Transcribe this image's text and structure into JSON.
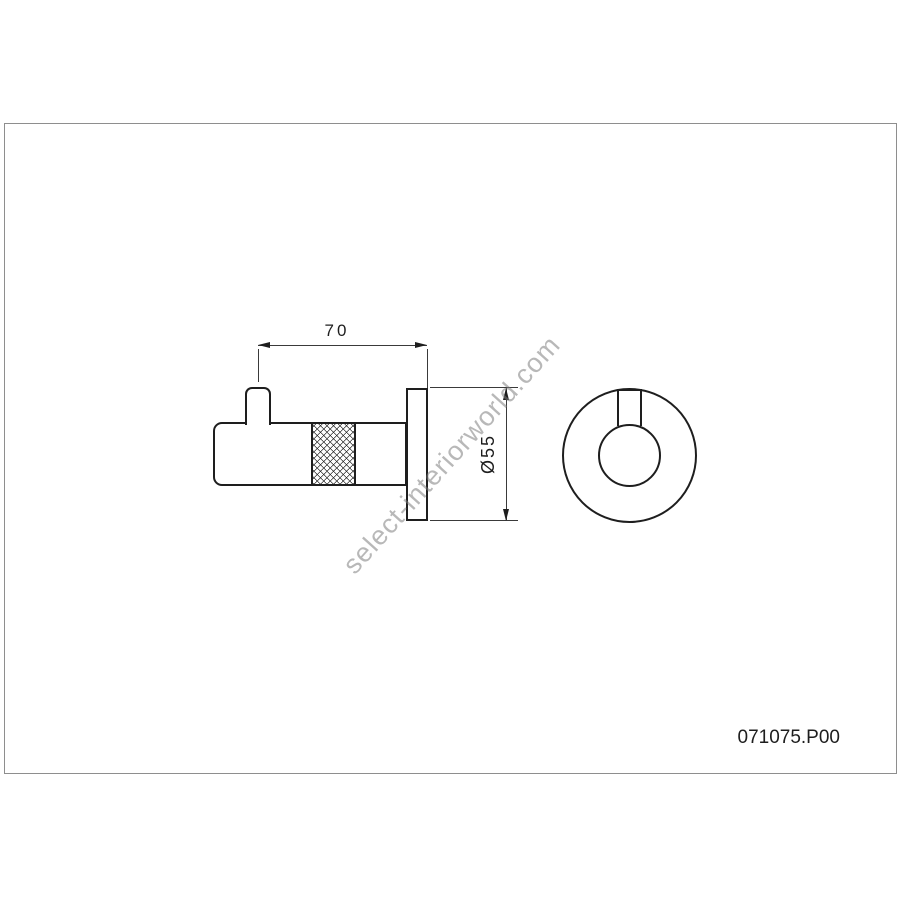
{
  "drawing": {
    "part_number": "071075.P00",
    "watermark": "select-interiorworld.com",
    "dimensions": {
      "projection_mm": "70",
      "plate_diameter_mm": "Ø55"
    },
    "views": {
      "side_view": "hook side profile with knurled grip and wall plate",
      "front_view": "wall plate front circle with hook pin"
    },
    "colors": {
      "line": "#1e1e1e",
      "dimension_line": "#3a3a3a",
      "frame_border": "#8e8e8e",
      "watermark": "#b3b3b3",
      "background": "#ffffff"
    }
  }
}
